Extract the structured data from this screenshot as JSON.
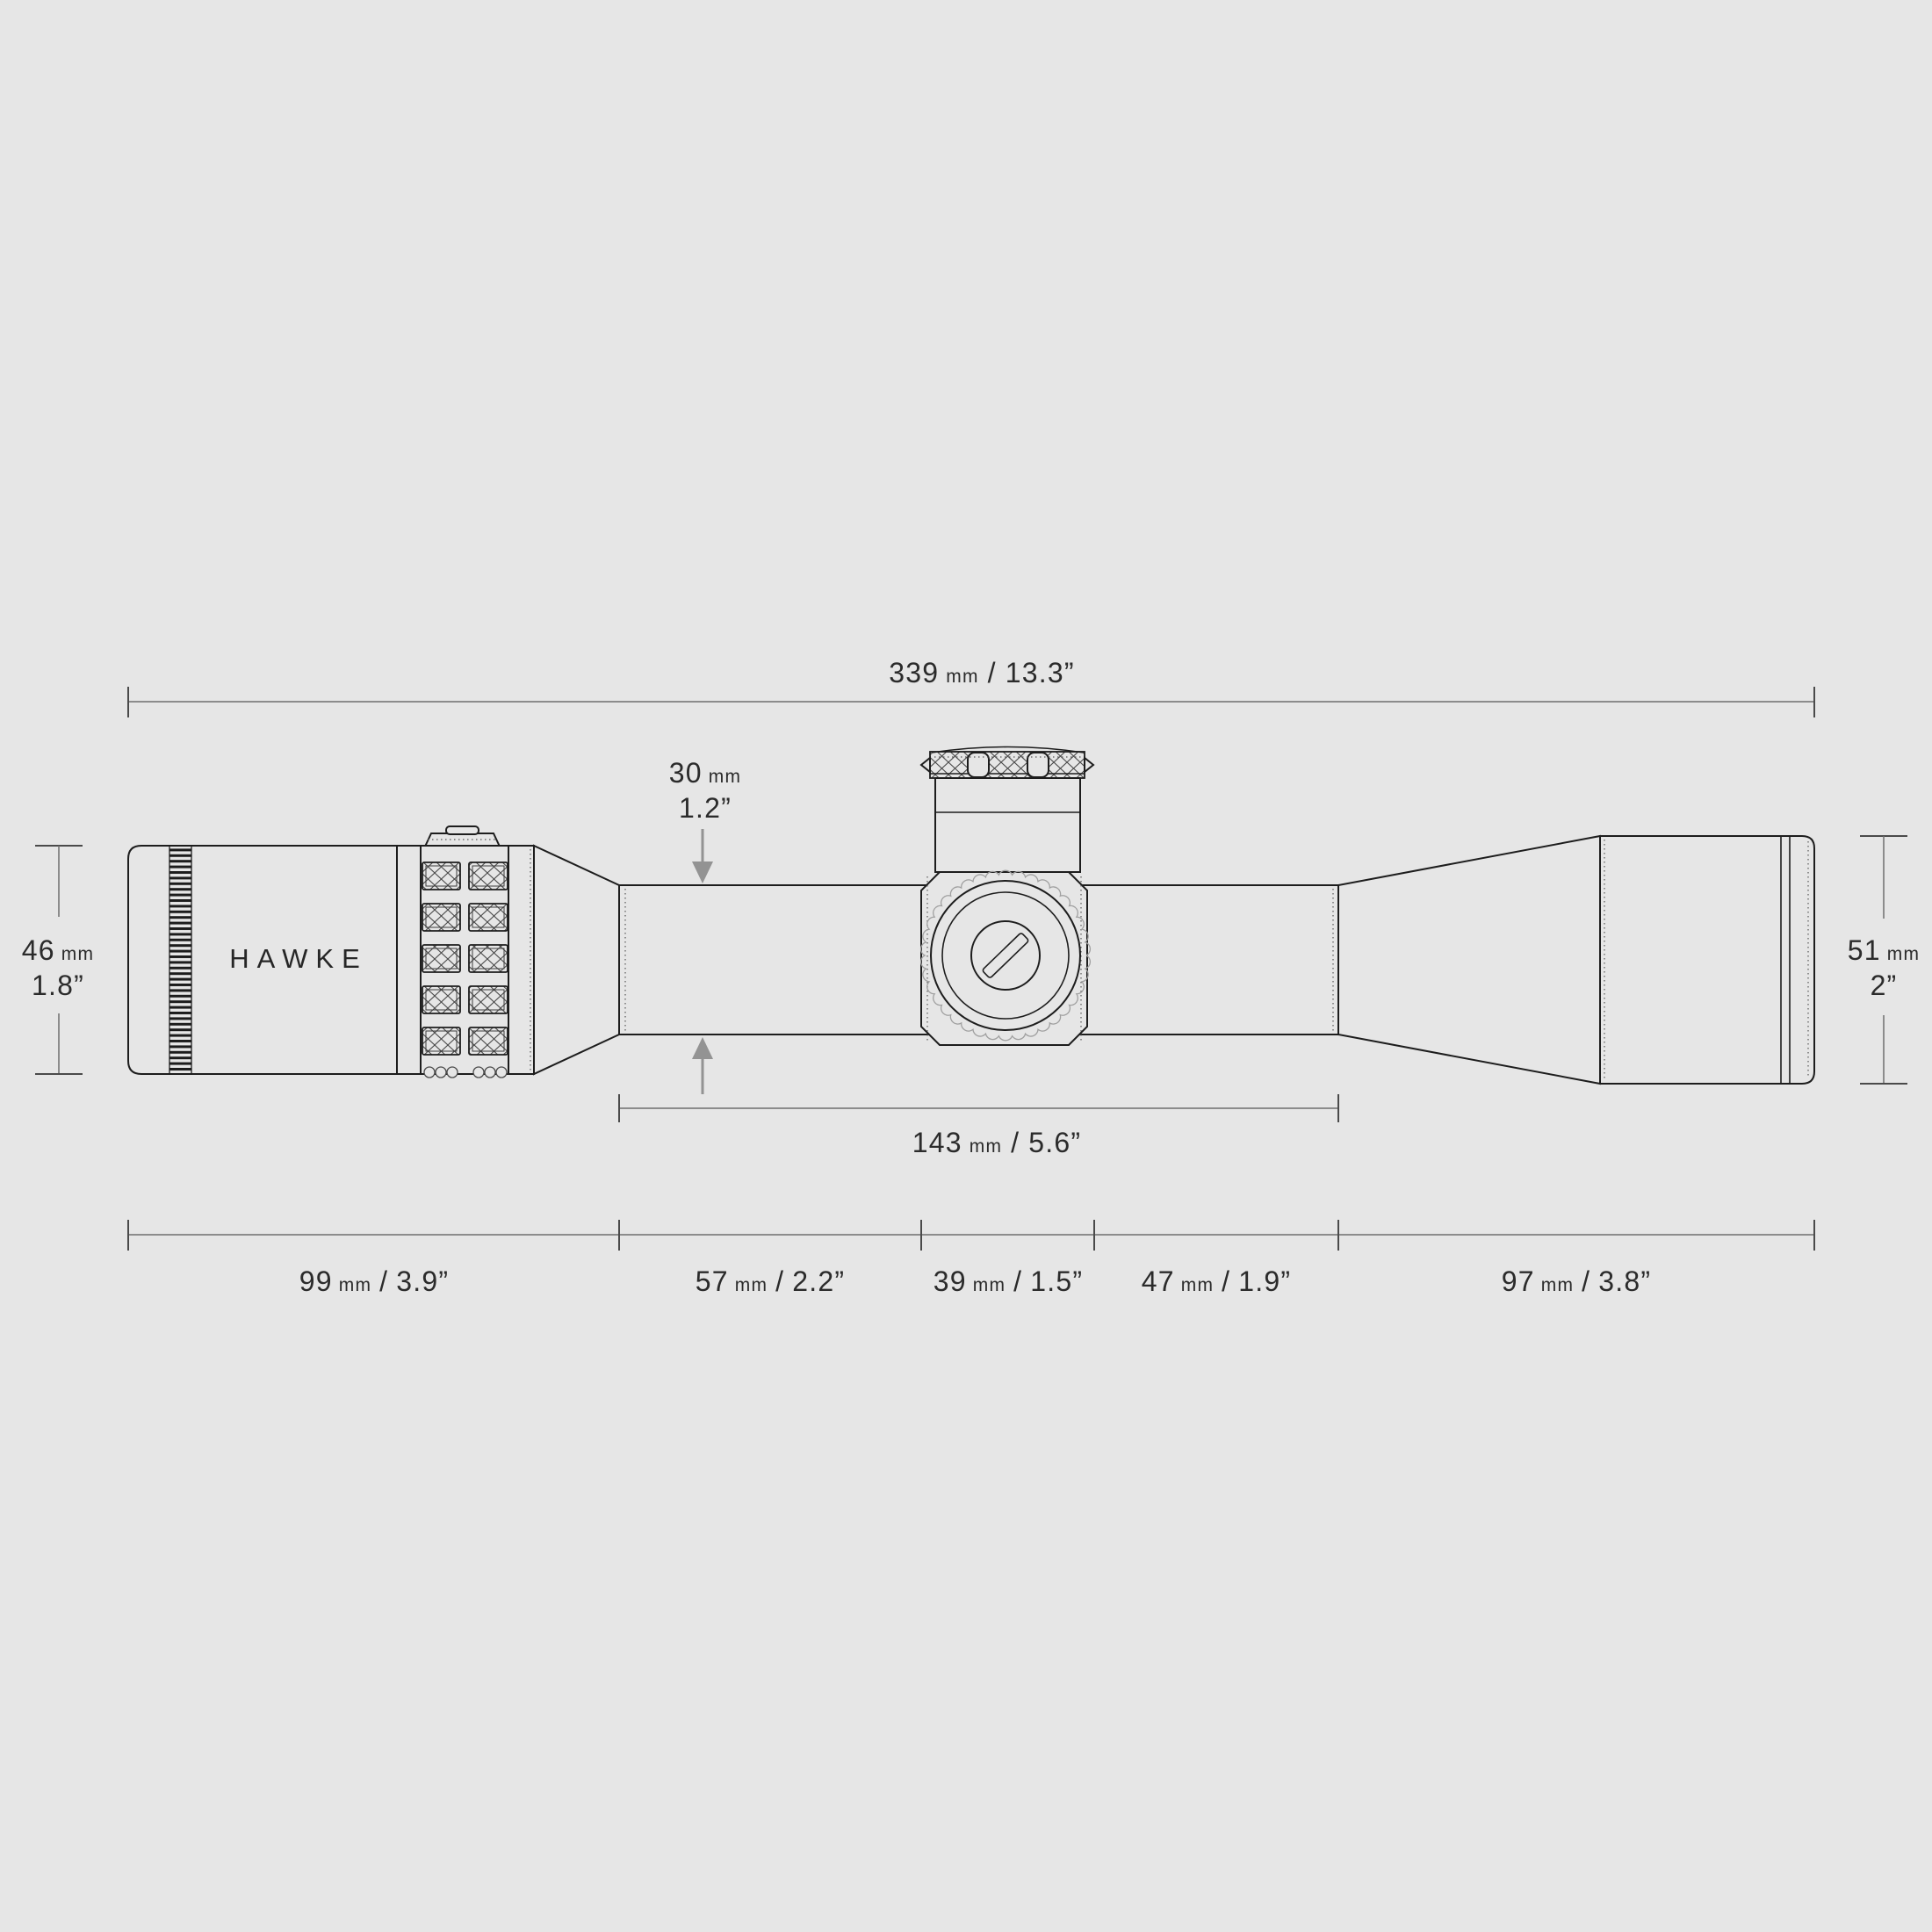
{
  "colors": {
    "background": "#e6e6e6",
    "outline_ink": "#1d1d1d",
    "dimension_line": "#6e6e6e",
    "tick": "#4a4a4a",
    "text": "#2b2b2b",
    "arrow": "#939393",
    "knurl_gray": "#a0a0a0"
  },
  "brand": {
    "logo": "HAWKE"
  },
  "dims": {
    "overall": {
      "mm": "339",
      "unit": "mm",
      "slash": "/",
      "in": "13.3”"
    },
    "tube": {
      "mm": "30",
      "unit": "mm",
      "in": "1.2”"
    },
    "ocular": {
      "mm": "46",
      "unit": "mm",
      "in": "1.8”"
    },
    "objective": {
      "mm": "51",
      "unit": "mm",
      "in": "2”"
    },
    "mount": {
      "mm": "143",
      "unit": "mm",
      "slash": "/",
      "in": "5.6”"
    },
    "segments": [
      {
        "mm": "99",
        "unit": "mm",
        "slash": "/",
        "in": "3.9”"
      },
      {
        "mm": "57",
        "unit": "mm",
        "slash": "/",
        "in": "2.2”"
      },
      {
        "mm": "39",
        "unit": "mm",
        "slash": "/",
        "in": "1.5”"
      },
      {
        "mm": "47",
        "unit": "mm",
        "slash": "/",
        "in": "1.9”"
      },
      {
        "mm": "97",
        "unit": "mm",
        "slash": "/",
        "in": "3.8”"
      }
    ]
  }
}
